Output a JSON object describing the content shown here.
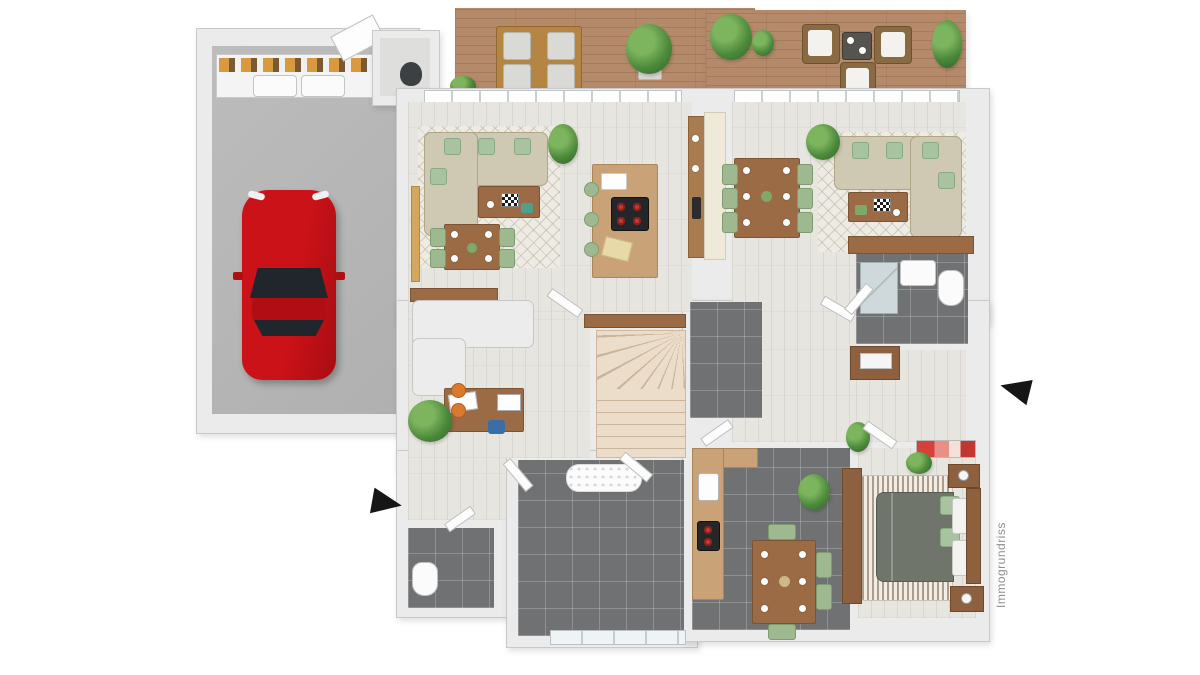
{
  "watermark": {
    "text": "Immogrundriss"
  },
  "palette": {
    "background": "#ffffff",
    "wall": "#ebebeb",
    "wall_edge": "#c9c9c9",
    "floor_wood_light": "#e7e5e0",
    "floor_tile_dark": "#6f7173",
    "floor_concrete": "#b7b7b7",
    "deck_wood": "#b48a6b",
    "car_red": "#c41016",
    "sofa_beige": "#cfc8b2",
    "cushion_green": "#a8c3a0",
    "furniture_wood": "#9a6b44",
    "stair_cream": "#ecddca",
    "bed_duvet": "#70756b",
    "artwork_red": "#d8403c",
    "arrow_black": "#161616",
    "watermark_gray": "#909090"
  }
}
